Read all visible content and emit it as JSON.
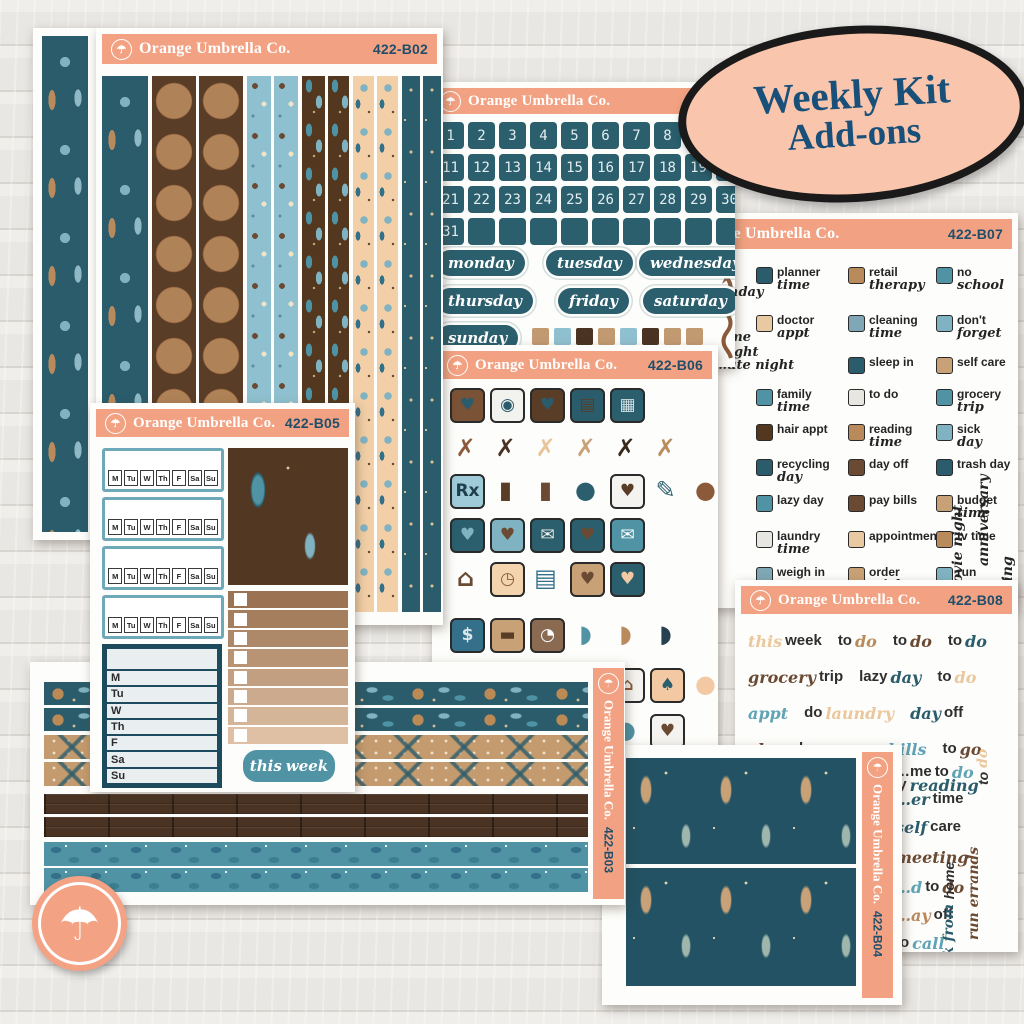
{
  "brand": "Orange Umbrella Co.",
  "logo_icon": "umbrella-icon",
  "badge": {
    "line1": "Weekly Kit",
    "line2": "Add-ons"
  },
  "colors": {
    "header_peach": "#f2a282",
    "badge_peach": "#f9c6ad",
    "navy": "#19507a",
    "teal_dark": "#2b5f6e",
    "teal_mid": "#4f93a4",
    "brown": "#5a3d26",
    "tan": "#c9a177"
  },
  "sheets": {
    "left_strip": {
      "strips": [
        "teal-figure"
      ]
    },
    "b02": {
      "code": "422-B02",
      "strips": [
        "teal-figure",
        "archer",
        "archer",
        "blue-critter",
        "blue-critter",
        "brown-leaf",
        "brown-leaf",
        "peach-floral",
        "peach-floral",
        "teal-dot",
        "teal-dot"
      ]
    },
    "dates": {
      "numbers": [
        "1",
        "2",
        "3",
        "4",
        "5",
        "6",
        "7",
        "8",
        "9",
        "10",
        "11",
        "12",
        "13",
        "14",
        "15",
        "16",
        "17",
        "18",
        "19",
        "20",
        "21",
        "22",
        "23",
        "24",
        "25",
        "26",
        "27",
        "28",
        "29",
        "30",
        "31"
      ],
      "blank_count": 9,
      "weekdays": [
        "monday",
        "tuesday",
        "wednesday",
        "thursday",
        "friday",
        "saturday",
        "sunday"
      ],
      "swatches": [
        "#c29a72",
        "#8fc0cf",
        "#4a3323",
        "#c29a72",
        "#8fc0cf",
        "#4a3323",
        "#c29a72",
        "#c29a72"
      ],
      "arrow_icon": "squiggle-arrow-icon"
    },
    "b06": {
      "code": "422-B06",
      "icons": [
        {
          "r": 0,
          "c": 0,
          "n": "shopping-bag-icon",
          "g": "♥",
          "b": "#7a5236",
          "f": "#2b5c6b"
        },
        {
          "r": 0,
          "c": 1,
          "n": "washing-machine-icon",
          "g": "◉",
          "b": "#f2f2ee",
          "f": "#2b5c6b"
        },
        {
          "r": 0,
          "c": 2,
          "n": "planner-notebook-icon",
          "g": "♥",
          "b": "#5a3d26",
          "f": "#2b5c6b"
        },
        {
          "r": 0,
          "c": 3,
          "n": "chocolate-bar-icon",
          "g": "▤",
          "b": "#2b5c6b",
          "f": "#5a3d26"
        },
        {
          "r": 0,
          "c": 4,
          "n": "calculator-icon",
          "g": "▦",
          "b": "#2b5f6e",
          "f": "#cfe0e5"
        },
        {
          "r": 1,
          "c": 0,
          "n": "fork-spoon-icon",
          "g": "✗",
          "b": "",
          "f": "#8a5a3a"
        },
        {
          "r": 1,
          "c": 1,
          "n": "fork-spoon-icon",
          "g": "✗",
          "b": "",
          "f": "#4a3323"
        },
        {
          "r": 1,
          "c": 2,
          "n": "fork-spoon-icon",
          "g": "✗",
          "b": "",
          "f": "#e8c49a"
        },
        {
          "r": 1,
          "c": 3,
          "n": "fork-spoon-icon",
          "g": "✗",
          "b": "",
          "f": "#c9a177"
        },
        {
          "r": 1,
          "c": 4,
          "n": "fork-spoon-icon",
          "g": "✗",
          "b": "",
          "f": "#3a2a1e"
        },
        {
          "r": 1,
          "c": 5,
          "n": "fork-spoon-icon",
          "g": "✗",
          "b": "",
          "f": "#b98a5c"
        },
        {
          "r": 2,
          "c": 0,
          "n": "rx-bottle-icon",
          "g": "Rx",
          "b": "#9fcbd8",
          "f": "#1f3f4e"
        },
        {
          "r": 2,
          "c": 1,
          "n": "trash-can-icon",
          "g": "▮",
          "b": "",
          "f": "#5a3d26"
        },
        {
          "r": 2,
          "c": 2,
          "n": "nail-polish-icon",
          "g": "▮",
          "b": "",
          "f": "#6b4a33"
        },
        {
          "r": 2,
          "c": 3,
          "n": "lightbulb-icon",
          "g": "●",
          "b": "",
          "f": "#2b5f6e"
        },
        {
          "r": 2,
          "c": 4,
          "n": "coffee-cup-icon",
          "g": "♥",
          "b": "#f5f3ef",
          "f": "#5a3d26"
        },
        {
          "r": 2,
          "c": 5,
          "n": "pencil-icon",
          "g": "✎",
          "b": "",
          "f": "#2b5f6e"
        },
        {
          "r": 2,
          "c": 6,
          "n": "balloons-icon",
          "g": "●",
          "b": "",
          "f": "#8a5a3a"
        },
        {
          "r": 3,
          "c": 0,
          "n": "laptop-icon",
          "g": "♥",
          "b": "#2b5f6e",
          "f": "#7fb3c2"
        },
        {
          "r": 3,
          "c": 1,
          "n": "folder-icon",
          "g": "♥",
          "b": "#7fb3c2",
          "f": "#6b4a33"
        },
        {
          "r": 3,
          "c": 2,
          "n": "bill-envelope-icon",
          "g": "✉",
          "b": "#2b5f6e",
          "f": "#f0f0ea"
        },
        {
          "r": 3,
          "c": 3,
          "n": "tv-icon",
          "g": "♥",
          "b": "#2b5f6e",
          "f": "#6b4a33"
        },
        {
          "r": 3,
          "c": 4,
          "n": "envelope-heart-icon",
          "g": "✉",
          "b": "#4f93a4",
          "f": "#ffffff"
        },
        {
          "r": 4,
          "c": 0,
          "n": "house-icon",
          "g": "⌂",
          "b": "",
          "f": "#6b4a33"
        },
        {
          "r": 4,
          "c": 1,
          "n": "alarm-clock-icon",
          "g": "◷",
          "b": "#f3d4ae",
          "f": "#8a5a3a"
        },
        {
          "r": 4,
          "c": 2,
          "n": "books-icon",
          "g": "▤",
          "b": "",
          "f": "#35708a"
        },
        {
          "r": 4,
          "c": 3,
          "n": "stethoscope-icon",
          "g": "♥",
          "b": "#c9a177",
          "f": "#6b4a33"
        },
        {
          "r": 4,
          "c": 4,
          "n": "box-of-hearts-icon",
          "g": "♥",
          "b": "#2b5f6e",
          "f": "#f3c9a3"
        },
        {
          "r": 5,
          "c": 0,
          "n": "money-icon",
          "g": "$",
          "b": "#35708a",
          "f": "#d9e6ea"
        },
        {
          "r": 5,
          "c": 1,
          "n": "credit-card-icon",
          "g": "▬",
          "b": "#c9a177",
          "f": "#5a3d26"
        },
        {
          "r": 5,
          "c": 2,
          "n": "scale-icon",
          "g": "◔",
          "b": "#8a6b52",
          "f": "#ffffff"
        },
        {
          "r": 5,
          "c": 3,
          "n": "sneaker-icon",
          "g": "◗",
          "b": "",
          "f": "#4f93a4"
        },
        {
          "r": 5,
          "c": 4,
          "n": "sneaker-icon",
          "g": "◗",
          "b": "",
          "f": "#b98a5c"
        },
        {
          "r": 5,
          "c": 5,
          "n": "sneaker-icon",
          "g": "◗",
          "b": "",
          "f": "#25404f"
        },
        {
          "r": 6,
          "c": 4,
          "n": "church-icon",
          "g": "⌂",
          "b": "#f5f3ef",
          "f": "#8a5a3a"
        },
        {
          "r": 6,
          "c": 5,
          "n": "potted-plant-icon",
          "g": "♠",
          "b": "#f3c9a3",
          "f": "#2b5f6e"
        },
        {
          "r": 6,
          "c": 6,
          "n": "balloons-icon",
          "g": "●",
          "b": "",
          "f": "#f3c9a3"
        },
        {
          "r": 7,
          "c": 4,
          "n": "paw-print-icon",
          "g": "●",
          "b": "",
          "f": "#4f93a4"
        },
        {
          "r": 7,
          "c": 5,
          "n": "phone-heart-icon",
          "g": "♥",
          "b": "#f5f3ef",
          "f": "#6b4a33"
        }
      ]
    },
    "b07": {
      "code": "422-B07",
      "items": [
        {
          "r": 0,
          "c": 0,
          "icon": "planner-icon",
          "ic": "#2b5c6b",
          "l1": "planner",
          "l2": "time"
        },
        {
          "r": 0,
          "c": 1,
          "icon": "money-icon",
          "ic": "#b98a5c",
          "l1": "retail",
          "l2": "therapy"
        },
        {
          "r": 0,
          "c": 2,
          "icon": "apple-icon",
          "ic": "#4f93a4",
          "l1": "no",
          "l2": "school"
        },
        {
          "r": 1,
          "c": 0,
          "icon": "stethoscope-icon",
          "ic": "#e9c9a2",
          "l1": "doctor",
          "l2": "appt"
        },
        {
          "r": 1,
          "c": 1,
          "icon": "spray-bottle-icon",
          "ic": "#7fa7b5",
          "l1": "cleaning",
          "l2": "time"
        },
        {
          "r": 1,
          "c": 2,
          "icon": "exclamation-icon",
          "ic": "#7fb3c2",
          "l1": "don't",
          "l2": "forget"
        },
        {
          "r": 2,
          "c": 1,
          "icon": "blanket-icon",
          "ic": "#2b5c6b",
          "l1": "sleep in",
          "l2": ""
        },
        {
          "r": 2,
          "c": 2,
          "icon": "sleep-mask-icon",
          "ic": "#c9a177",
          "l1": "self care",
          "l2": ""
        },
        {
          "r": 3,
          "c": 0,
          "icon": "clock-icon",
          "ic": "#4f93a4",
          "l1": "family",
          "l2": "time"
        },
        {
          "r": 3,
          "c": 1,
          "icon": "clipboard-icon",
          "ic": "#e8e6e0",
          "l1": "to do",
          "l2": ""
        },
        {
          "r": 3,
          "c": 2,
          "icon": "grocery-cart-icon",
          "ic": "#4f93a4",
          "l1": "grocery",
          "l2": "trip"
        },
        {
          "r": 4,
          "c": 0,
          "icon": "hair-dryer-icon",
          "ic": "#53381f",
          "l1": "hair appt",
          "l2": ""
        },
        {
          "r": 4,
          "c": 1,
          "icon": "books-icon",
          "ic": "#b98a5c",
          "l1": "reading",
          "l2": "time"
        },
        {
          "r": 4,
          "c": 2,
          "icon": "medical-cross-icon",
          "ic": "#7fb3c2",
          "l1": "sick",
          "l2": "day"
        },
        {
          "r": 5,
          "c": 0,
          "icon": "recycle-icon",
          "ic": "#2b5c6b",
          "l1": "recycling",
          "l2": "day"
        },
        {
          "r": 5,
          "c": 1,
          "icon": "briefcase-icon",
          "ic": "#6b4a33",
          "l1": "day off",
          "l2": ""
        },
        {
          "r": 5,
          "c": 2,
          "icon": "trash-can-icon",
          "ic": "#2b5c6b",
          "l1": "trash day",
          "l2": ""
        },
        {
          "r": 6,
          "c": 0,
          "icon": "couch-icon",
          "ic": "#4f93a4",
          "l1": "lazy day",
          "l2": ""
        },
        {
          "r": 6,
          "c": 1,
          "icon": "wallet-icon",
          "ic": "#6b4a33",
          "l1": "pay bills",
          "l2": ""
        },
        {
          "r": 6,
          "c": 2,
          "icon": "calculator-icon",
          "ic": "#c9a177",
          "l1": "budget",
          "l2": "time"
        },
        {
          "r": 7,
          "c": 0,
          "icon": "washing-machine-icon",
          "ic": "#e8e6e0",
          "l1": "laundry",
          "l2": "time"
        },
        {
          "r": 7,
          "c": 1,
          "icon": "alarm-clock-icon",
          "ic": "#e9c9a2",
          "l1": "appointment",
          "l2": ""
        },
        {
          "r": 7,
          "c": 2,
          "icon": "tv-icon",
          "ic": "#b98a5c",
          "l1": "tv time",
          "l2": ""
        },
        {
          "r": 8,
          "c": 0,
          "icon": "scale-icon",
          "ic": "#7fa7b5",
          "l1": "weigh in",
          "l2": ""
        },
        {
          "r": 8,
          "c": 1,
          "icon": "sticker-sheet-icon",
          "ic": "#c9a177",
          "l1": "order",
          "l2": "stickers"
        },
        {
          "r": 8,
          "c": 2,
          "icon": "car-icon",
          "ic": "#7fb3c2",
          "l1": "run",
          "l2": "errands"
        }
      ],
      "fragments": [
        "…hday",
        "…me\n…ight",
        "…ute night"
      ],
      "verticals": [
        "movie night",
        "anniversary",
        "…ting"
      ]
    },
    "b08": {
      "code": "422-B08",
      "colors": {
        "k": "#2e2e2e",
        "b": "#6b4a33",
        "t": "#2b5c6b",
        "l": "#5fa3b5",
        "p": "#eac79c",
        "a": "#b98a5c"
      },
      "rows": [
        [
          [
            [
              "this",
              "p",
              1
            ],
            [
              "week",
              "k",
              0
            ]
          ],
          [
            [
              "to",
              "k",
              0
            ],
            [
              "do",
              "a",
              1
            ]
          ],
          [
            [
              "to",
              "k",
              0
            ],
            [
              "do",
              "b",
              1
            ]
          ],
          [
            [
              "to",
              "k",
              0
            ],
            [
              "do",
              "t",
              1
            ]
          ]
        ],
        [
          [
            [
              "grocery",
              "b",
              1
            ],
            [
              "trip",
              "k",
              0
            ]
          ],
          [
            [
              "lazy",
              "k",
              0
            ],
            [
              "day",
              "t",
              1
            ]
          ],
          [
            [
              "to",
              "k",
              0
            ],
            [
              "do",
              "p",
              1
            ]
          ]
        ],
        [
          [
            [
              "appt",
              "l",
              1
            ]
          ],
          [
            [
              "do",
              "k",
              0
            ],
            [
              "laundry",
              "p",
              1
            ]
          ],
          [
            [
              "day",
              "t",
              1
            ],
            [
              "off",
              "k",
              0
            ]
          ]
        ],
        [
          [
            [
              "clean",
              "b",
              1
            ],
            [
              "house",
              "k",
              0
            ]
          ],
          [
            [
              "pay",
              "k",
              0
            ],
            [
              "bills",
              "l",
              1
            ]
          ],
          [
            [
              "to",
              "k",
              0
            ],
            [
              "go",
              "b",
              1
            ]
          ]
        ],
        [
          [
            [
              "next",
              "t",
              1
            ],
            [
              "week",
              "k",
              0
            ]
          ],
          [
            [
              "currently",
              "k",
              0
            ],
            [
              "reading",
              "t",
              1
            ]
          ]
        ]
      ],
      "right_items": [
        [
          [
            "…me",
            "k",
            0
          ],
          [
            "to",
            "k",
            0
          ],
          [
            "do",
            "l",
            1
          ]
        ],
        [
          [
            "…er",
            "t",
            1
          ],
          [
            "time",
            "k",
            0
          ]
        ],
        [
          [
            "self",
            "t",
            1
          ],
          [
            "care",
            "k",
            0
          ]
        ],
        [
          [
            "meeting",
            "b",
            1
          ]
        ],
        [
          [
            "…d",
            "l",
            1
          ],
          [
            "to",
            "k",
            0
          ],
          [
            "do",
            "b",
            1
          ]
        ],
        [
          [
            "…ay",
            "a",
            1
          ],
          [
            "off",
            "k",
            0
          ]
        ],
        [
          [
            "to",
            "k",
            0
          ],
          [
            "call",
            "l",
            1
          ]
        ]
      ],
      "verticals": [
        [
          [
            "to",
            "k",
            0
          ],
          [
            "do",
            "p",
            1
          ]
        ],
        [
          [
            "run",
            "b",
            1
          ],
          [
            "errands",
            "b",
            1
          ]
        ],
        [
          [
            "work from",
            "t",
            1
          ],
          [
            "home",
            "k",
            0
          ]
        ]
      ]
    },
    "b05": {
      "code": "422-B05",
      "days": [
        "M",
        "Tu",
        "W",
        "Th",
        "F",
        "Sa",
        "Su"
      ],
      "tracker_count": 4,
      "checklist_rows": 8,
      "this_week": [
        "this",
        "week"
      ]
    },
    "b03": {
      "code": "422-B03",
      "strips": [
        "teal-floral",
        "teal-floral",
        "tan-x",
        "tan-x",
        "wood",
        "wood",
        "teal-leaf",
        "teal-leaf"
      ]
    },
    "b04": {
      "code": "422-B04",
      "panels": [
        "feather",
        "feather"
      ]
    }
  }
}
